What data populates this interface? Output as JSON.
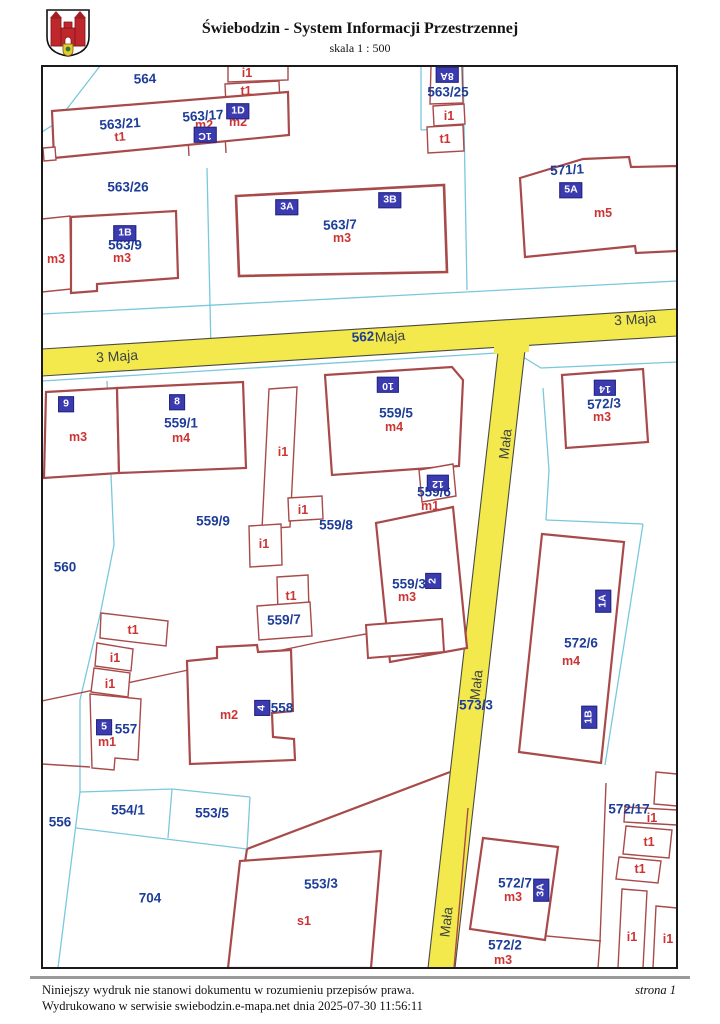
{
  "header": {
    "title": "Świebodzin - System Informacji Przestrzennej",
    "scale": "skala 1 : 500",
    "logo": "coat-of-arms-swiebodzin"
  },
  "footer": {
    "line1": "Niniejszy wydruk nie stanowi dokumentu w rozumieniu przepisów prawa.",
    "line2": "Wydrukowano w serwisie swiebodzin.e-mapa.net dnia 2025-07-30 11:56:11",
    "page": "strona 1"
  },
  "colors": {
    "road_fill": "#f3e94d",
    "road_edge": "#4a4a44",
    "parcel_line": "#79c8dc",
    "building_outline": "#a84a4a",
    "parcel_number_text": "#1d3d99",
    "building_type_text": "#cc3434",
    "address_plate_bg": "#3b3bb0",
    "address_plate_text": "#ffffff",
    "street_text": "#3d4245",
    "frame": "#1a1a1a"
  },
  "map": {
    "street_labels": [
      {
        "text": "3 Maja",
        "x": 117,
        "y": 356,
        "rot": -3.6
      },
      {
        "text": "Maja",
        "x": 390,
        "y": 336,
        "rot": -3.6
      },
      {
        "text": "3 Maja",
        "x": 635,
        "y": 319,
        "rot": -3.6
      },
      {
        "text": "Mała",
        "x": 505,
        "y": 444,
        "rot": -83.5
      },
      {
        "text": "Mała",
        "x": 476,
        "y": 685,
        "rot": -83.5
      },
      {
        "text": "Mała",
        "x": 446,
        "y": 922,
        "rot": -83.5
      }
    ],
    "parcel_labels": [
      {
        "text": "564",
        "x": 145,
        "y": 79,
        "rot": -2
      },
      {
        "text": "563/21",
        "x": 120,
        "y": 124,
        "rot": -4
      },
      {
        "text": "563/17",
        "x": 203,
        "y": 116,
        "rot": -4
      },
      {
        "text": "563/25",
        "x": 448,
        "y": 92,
        "rot": 0
      },
      {
        "text": "563/26",
        "x": 128,
        "y": 187,
        "rot": 0
      },
      {
        "text": "563/9",
        "x": 125,
        "y": 245,
        "rot": 0
      },
      {
        "text": "563/7",
        "x": 340,
        "y": 225,
        "rot": -2
      },
      {
        "text": "571/1",
        "x": 567,
        "y": 170,
        "rot": -3
      },
      {
        "text": "562",
        "x": 363,
        "y": 337,
        "rot": -3.6
      },
      {
        "text": "572/3",
        "x": 604,
        "y": 404,
        "rot": -3
      },
      {
        "text": "559/1",
        "x": 181,
        "y": 423,
        "rot": 0
      },
      {
        "text": "559/5",
        "x": 396,
        "y": 413,
        "rot": 0
      },
      {
        "text": "559/6",
        "x": 434,
        "y": 492,
        "rot": 0
      },
      {
        "text": "559/9",
        "x": 213,
        "y": 521,
        "rot": 0
      },
      {
        "text": "559/8",
        "x": 336,
        "y": 525,
        "rot": 0
      },
      {
        "text": "560",
        "x": 65,
        "y": 567,
        "rot": 0
      },
      {
        "text": "559/3",
        "x": 409,
        "y": 584,
        "rot": 0
      },
      {
        "text": "559/7",
        "x": 284,
        "y": 620,
        "rot": -2
      },
      {
        "text": "572/6",
        "x": 581,
        "y": 643,
        "rot": 0
      },
      {
        "text": "558",
        "x": 282,
        "y": 708,
        "rot": 0
      },
      {
        "text": "557",
        "x": 126,
        "y": 729,
        "rot": 0
      },
      {
        "text": "573/3",
        "x": 476,
        "y": 705,
        "rot": 0
      },
      {
        "text": "554/1",
        "x": 128,
        "y": 810,
        "rot": 0
      },
      {
        "text": "553/5",
        "x": 212,
        "y": 813,
        "rot": 0
      },
      {
        "text": "556",
        "x": 60,
        "y": 822,
        "rot": 0
      },
      {
        "text": "572/17",
        "x": 629,
        "y": 809,
        "rot": 0
      },
      {
        "text": "704",
        "x": 150,
        "y": 898,
        "rot": 0
      },
      {
        "text": "553/3",
        "x": 321,
        "y": 884,
        "rot": -2
      },
      {
        "text": "572/7",
        "x": 515,
        "y": 883,
        "rot": 0
      },
      {
        "text": "572/2",
        "x": 505,
        "y": 945,
        "rot": 0
      }
    ],
    "building_labels": [
      {
        "text": "i1",
        "x": 247,
        "y": 73,
        "rot": 0
      },
      {
        "text": "t1",
        "x": 246,
        "y": 91,
        "rot": 0
      },
      {
        "text": "t1",
        "x": 120,
        "y": 137,
        "rot": -4
      },
      {
        "text": "m2",
        "x": 204,
        "y": 125,
        "rot": 0
      },
      {
        "text": "m2",
        "x": 238,
        "y": 122,
        "rot": 0
      },
      {
        "text": "m3",
        "x": 56,
        "y": 259,
        "rot": 0
      },
      {
        "text": "m3",
        "x": 122,
        "y": 258,
        "rot": 0
      },
      {
        "text": "m3",
        "x": 342,
        "y": 238,
        "rot": 0
      },
      {
        "text": "i1",
        "x": 449,
        "y": 116,
        "rot": 0
      },
      {
        "text": "t1",
        "x": 445,
        "y": 139,
        "rot": 0
      },
      {
        "text": "m5",
        "x": 603,
        "y": 213,
        "rot": 0
      },
      {
        "text": "m3",
        "x": 602,
        "y": 417,
        "rot": 0
      },
      {
        "text": "m3",
        "x": 78,
        "y": 437,
        "rot": 0
      },
      {
        "text": "m4",
        "x": 181,
        "y": 438,
        "rot": 0
      },
      {
        "text": "m4",
        "x": 394,
        "y": 427,
        "rot": 0
      },
      {
        "text": "m1",
        "x": 430,
        "y": 506,
        "rot": 0
      },
      {
        "text": "i1",
        "x": 283,
        "y": 452,
        "rot": 0
      },
      {
        "text": "i1",
        "x": 303,
        "y": 510,
        "rot": 0
      },
      {
        "text": "i1",
        "x": 264,
        "y": 544,
        "rot": 0
      },
      {
        "text": "t1",
        "x": 291,
        "y": 596,
        "rot": 0
      },
      {
        "text": "m3",
        "x": 407,
        "y": 597,
        "rot": 0
      },
      {
        "text": "m4",
        "x": 571,
        "y": 661,
        "rot": 0
      },
      {
        "text": "t1",
        "x": 133,
        "y": 630,
        "rot": 0
      },
      {
        "text": "i1",
        "x": 115,
        "y": 658,
        "rot": 0
      },
      {
        "text": "i1",
        "x": 110,
        "y": 684,
        "rot": 0
      },
      {
        "text": "m1",
        "x": 107,
        "y": 742,
        "rot": 0
      },
      {
        "text": "m2",
        "x": 229,
        "y": 715,
        "rot": 0
      },
      {
        "text": "s1",
        "x": 304,
        "y": 921,
        "rot": 0
      },
      {
        "text": "m3",
        "x": 513,
        "y": 897,
        "rot": 0
      },
      {
        "text": "m3",
        "x": 503,
        "y": 960,
        "rot": 0
      },
      {
        "text": "i1",
        "x": 652,
        "y": 818,
        "rot": 0
      },
      {
        "text": "t1",
        "x": 649,
        "y": 842,
        "rot": 0
      },
      {
        "text": "t1",
        "x": 640,
        "y": 869,
        "rot": 0
      },
      {
        "text": "i1",
        "x": 632,
        "y": 937,
        "rot": 0
      },
      {
        "text": "i1",
        "x": 668,
        "y": 939,
        "rot": 0
      }
    ],
    "address_labels": [
      {
        "text": "1D",
        "x": 238,
        "y": 111,
        "rot": 0
      },
      {
        "text": "1C",
        "x": 205,
        "y": 135,
        "rot": 180
      },
      {
        "text": "8A",
        "x": 447,
        "y": 75,
        "rot": 180
      },
      {
        "text": "1B",
        "x": 125,
        "y": 233,
        "rot": 0
      },
      {
        "text": "3A",
        "x": 287,
        "y": 207,
        "rot": 0
      },
      {
        "text": "3B",
        "x": 390,
        "y": 200,
        "rot": 0
      },
      {
        "text": "5A",
        "x": 571,
        "y": 190,
        "rot": 0
      },
      {
        "text": "9",
        "x": 66,
        "y": 404,
        "rot": 0
      },
      {
        "text": "8",
        "x": 177,
        "y": 402,
        "rot": 0
      },
      {
        "text": "10",
        "x": 388,
        "y": 385,
        "rot": 180
      },
      {
        "text": "14",
        "x": 605,
        "y": 388,
        "rot": 180
      },
      {
        "text": "12",
        "x": 438,
        "y": 483,
        "rot": 180
      },
      {
        "text": "2",
        "x": 433,
        "y": 581,
        "rot": -90
      },
      {
        "text": "1A",
        "x": 603,
        "y": 601,
        "rot": -90
      },
      {
        "text": "1B",
        "x": 589,
        "y": 717,
        "rot": -90
      },
      {
        "text": "4",
        "x": 262,
        "y": 708,
        "rot": -90
      },
      {
        "text": "3A",
        "x": 541,
        "y": 890,
        "rot": -90
      },
      {
        "text": "5",
        "x": 104,
        "y": 727,
        "rot": 0
      }
    ]
  }
}
